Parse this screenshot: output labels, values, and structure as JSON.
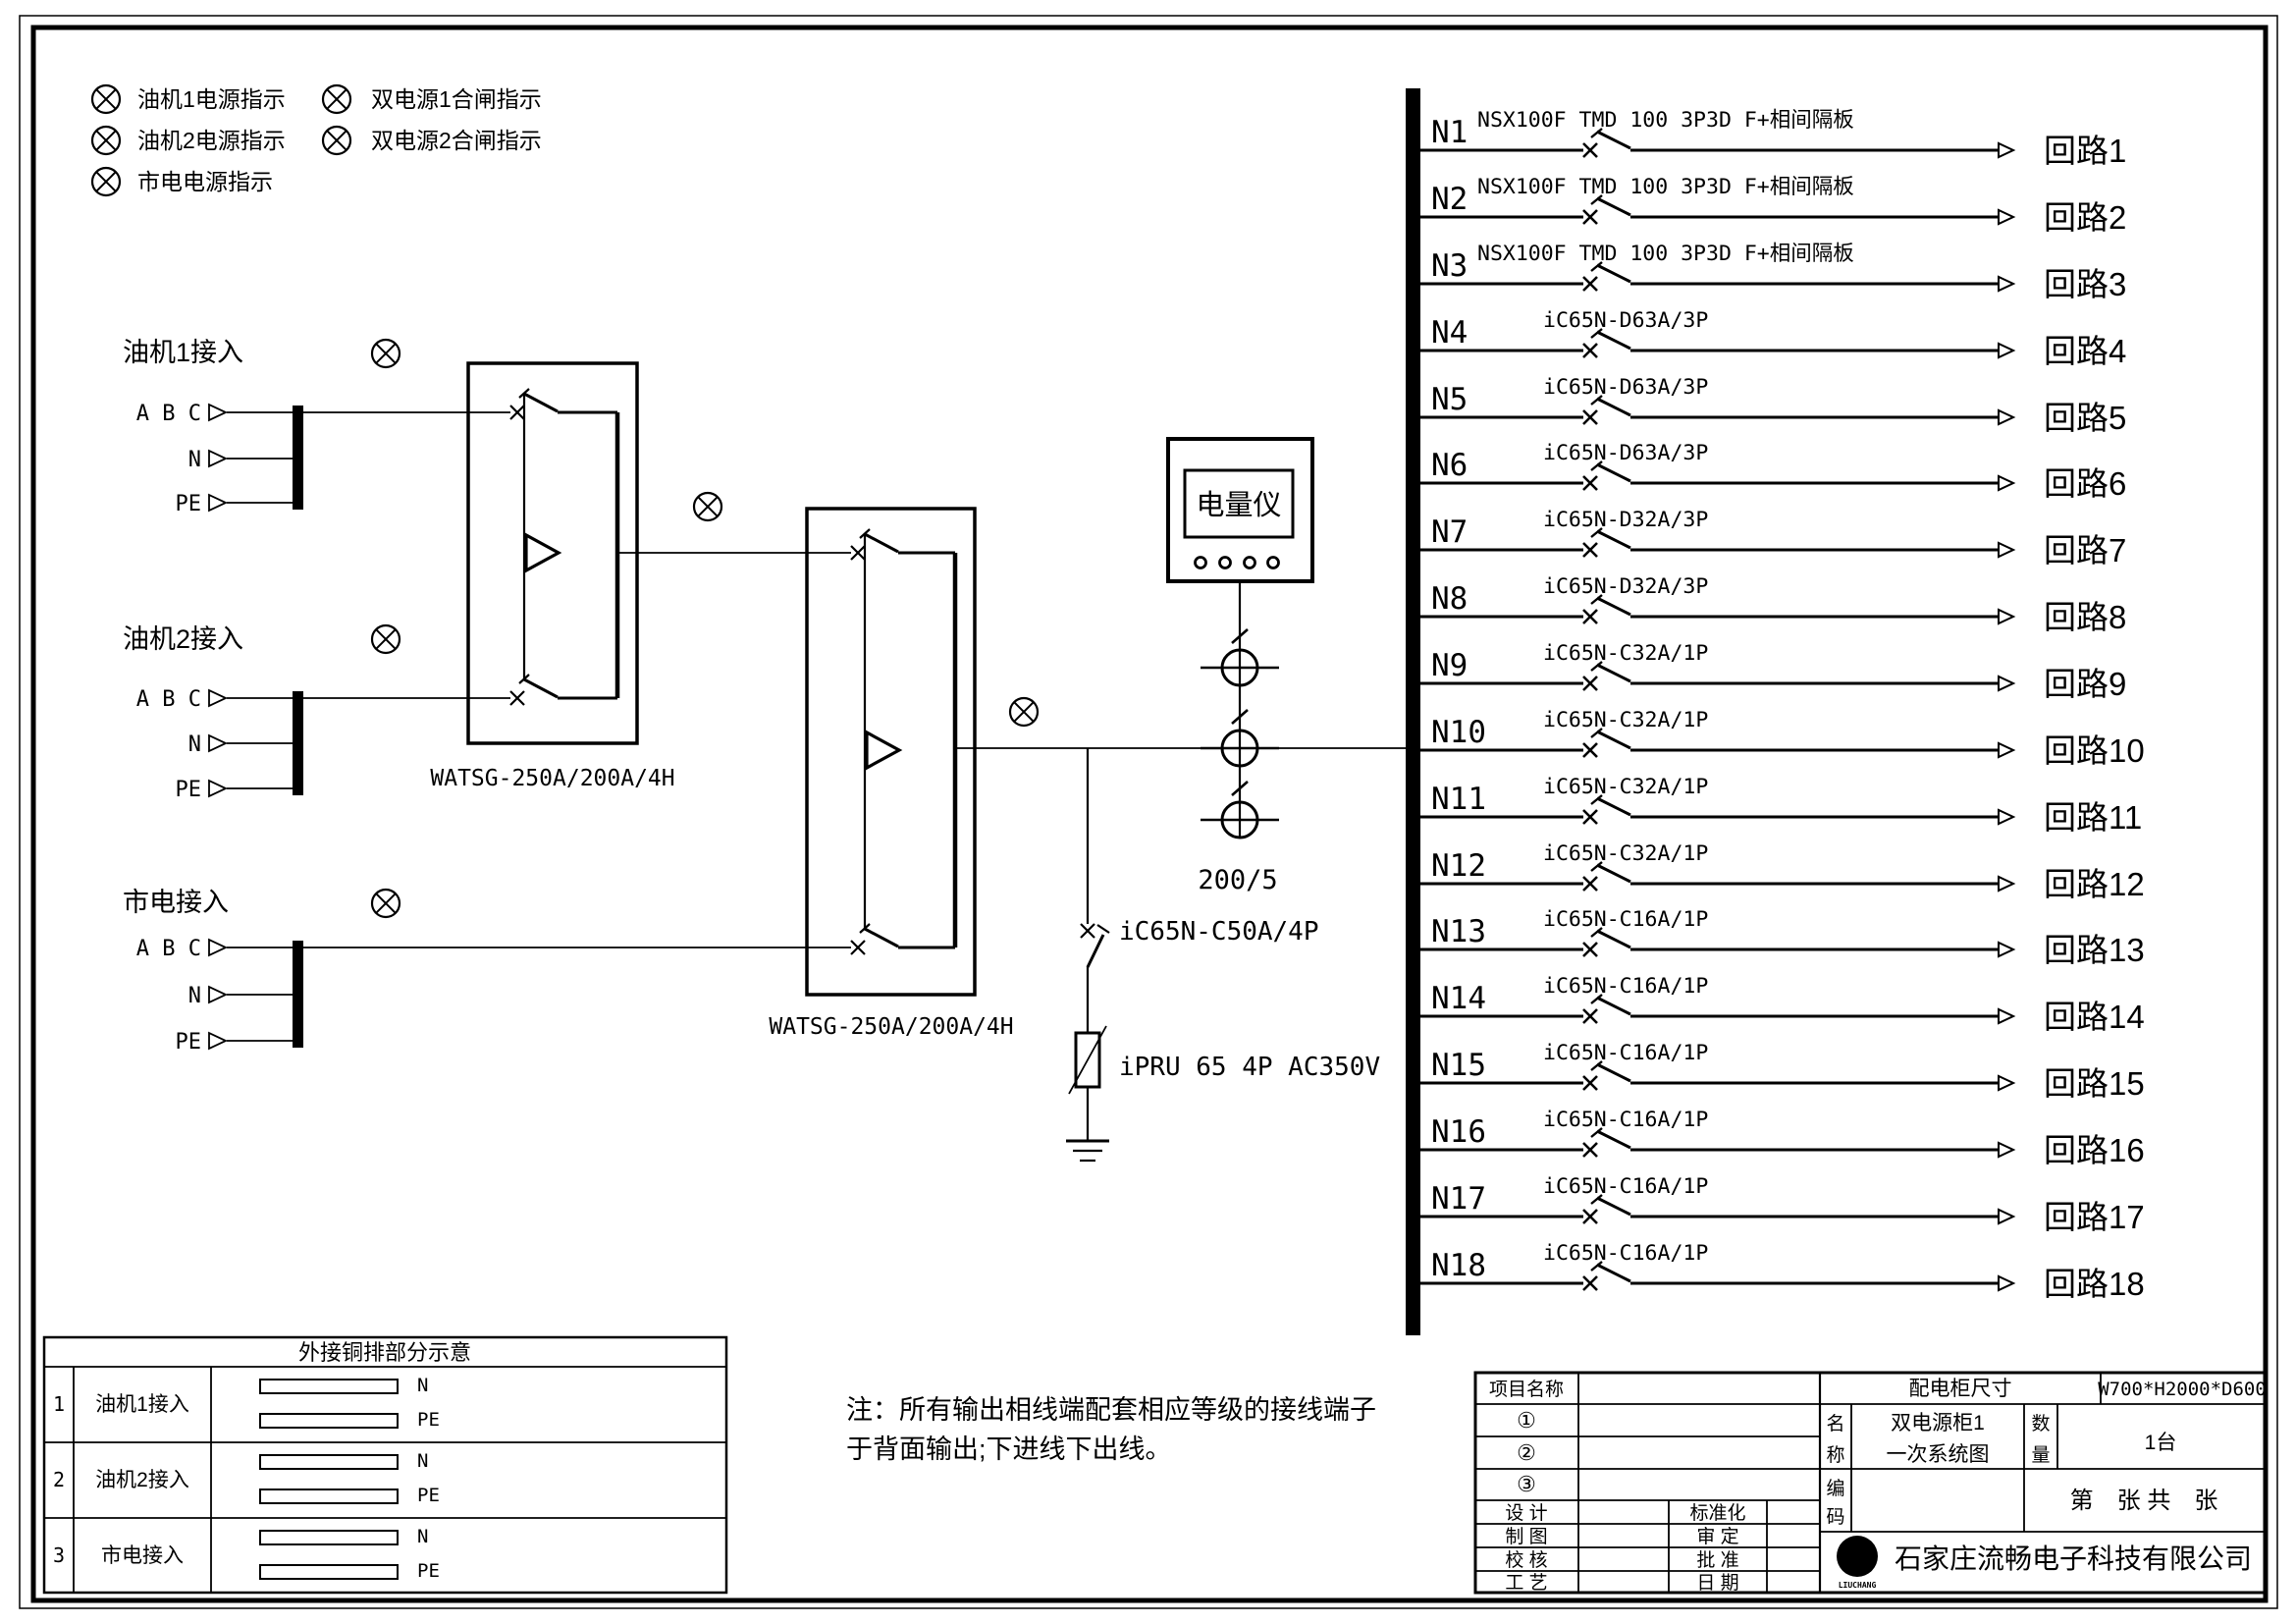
{
  "legend": {
    "col1": [
      "油机1电源指示",
      "油机2电源指示",
      "市电电源指示"
    ],
    "col2": [
      "双电源1合闸指示",
      "双电源2合闸指示"
    ]
  },
  "inputs": [
    {
      "title": "油机1接入",
      "l1": "A B C",
      "l2": "N",
      "l3": "PE"
    },
    {
      "title": "油机2接入",
      "l1": "A B C",
      "l2": "N",
      "l3": "PE"
    },
    {
      "title": "市电接入",
      "l1": "A B C",
      "l2": "N",
      "l3": "PE"
    }
  ],
  "ats": {
    "label1": "WATSG-250A/200A/4H",
    "label2": "WATSG-250A/200A/4H"
  },
  "meter": {
    "name": "电量仪",
    "ratio": "200/5"
  },
  "spd": {
    "breaker": "iC65N-C50A/4P",
    "device": "iPRU 65 4P AC350V"
  },
  "note": {
    "line1": "注：所有输出相线端配套相应等级的接线端子",
    "line2": "于背面输出;下进线下出线。"
  },
  "circuits": [
    {
      "n": "N1",
      "model": "NSX100F TMD 100 3P3D F+相间隔板",
      "name": "回路1"
    },
    {
      "n": "N2",
      "model": "NSX100F TMD 100 3P3D F+相间隔板",
      "name": "回路2"
    },
    {
      "n": "N3",
      "model": "NSX100F TMD 100 3P3D F+相间隔板",
      "name": "回路3"
    },
    {
      "n": "N4",
      "model": "iC65N-D63A/3P",
      "name": "回路4"
    },
    {
      "n": "N5",
      "model": "iC65N-D63A/3P",
      "name": "回路5"
    },
    {
      "n": "N6",
      "model": "iC65N-D63A/3P",
      "name": "回路6"
    },
    {
      "n": "N7",
      "model": "iC65N-D32A/3P",
      "name": "回路7"
    },
    {
      "n": "N8",
      "model": "iC65N-D32A/3P",
      "name": "回路8"
    },
    {
      "n": "N9",
      "model": "iC65N-C32A/1P",
      "name": "回路9"
    },
    {
      "n": "N10",
      "model": "iC65N-C32A/1P",
      "name": "回路10"
    },
    {
      "n": "N11",
      "model": "iC65N-C32A/1P",
      "name": "回路11"
    },
    {
      "n": "N12",
      "model": "iC65N-C32A/1P",
      "name": "回路12"
    },
    {
      "n": "N13",
      "model": "iC65N-C16A/1P",
      "name": "回路13"
    },
    {
      "n": "N14",
      "model": "iC65N-C16A/1P",
      "name": "回路14"
    },
    {
      "n": "N15",
      "model": "iC65N-C16A/1P",
      "name": "回路15"
    },
    {
      "n": "N16",
      "model": "iC65N-C16A/1P",
      "name": "回路16"
    },
    {
      "n": "N17",
      "model": "iC65N-C16A/1P",
      "name": "回路17"
    },
    {
      "n": "N18",
      "model": "iC65N-C16A/1P",
      "name": "回路18"
    }
  ],
  "copper_table": {
    "title": "外接铜排部分示意",
    "rows": [
      {
        "no": "1",
        "label": "油机1接入",
        "bar1": "N",
        "bar2": "PE"
      },
      {
        "no": "2",
        "label": "油机2接入",
        "bar1": "N",
        "bar2": "PE"
      },
      {
        "no": "3",
        "label": "市电接入",
        "bar1": "N",
        "bar2": "PE"
      }
    ]
  },
  "titleblock": {
    "project_label": "项目名称",
    "c1": "①",
    "c2": "②",
    "c3": "③",
    "design": "设  计",
    "draft": "制  图",
    "check": "校  核",
    "craft": "工  艺",
    "standard": "标准化",
    "review": "审  定",
    "approve": "批  准",
    "date": "日  期",
    "size_label": "配电柜尺寸",
    "size_value": "W700*H2000*D600",
    "name_l1": "名",
    "name_l2": "称",
    "name_v1": "双电源柜1",
    "name_v2": "一次系统图",
    "qty_l1": "数",
    "qty_l2": "量",
    "qty_value": "1台",
    "code_l1": "编",
    "code_l2": "码",
    "sheet": "第　张 共　张",
    "company": "石家庄流畅电子科技有限公司",
    "logo_letter": "G",
    "logo_sub": "LIUCHANG"
  }
}
